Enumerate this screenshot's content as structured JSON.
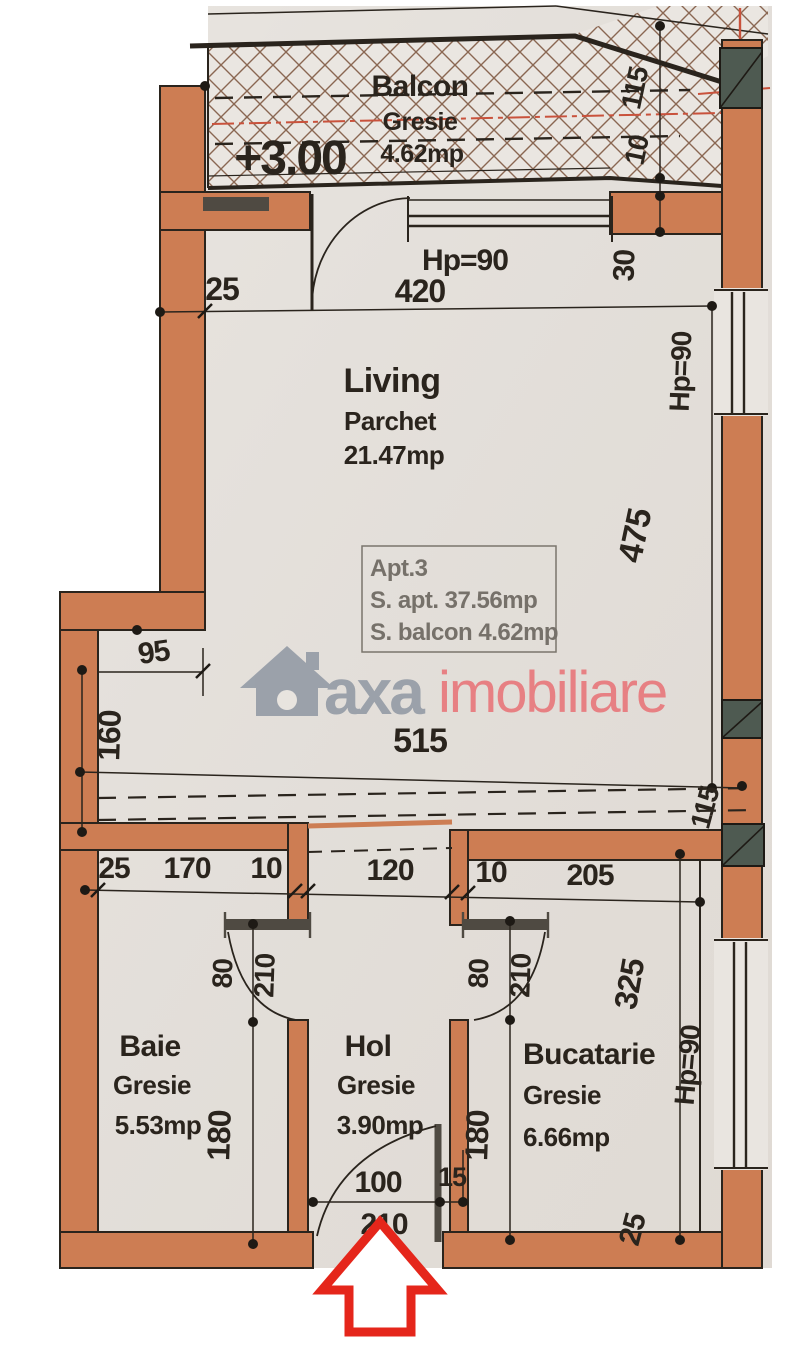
{
  "plan": {
    "level_marker": "+3.00",
    "rooms": {
      "balcon": {
        "name": "Balcon",
        "finish": "Gresie",
        "area": "4.62mp"
      },
      "living": {
        "name": "Living",
        "finish": "Parchet",
        "area": "21.47mp"
      },
      "baie": {
        "name": "Baie",
        "finish": "Gresie",
        "area": "5.53mp"
      },
      "hol": {
        "name": "Hol",
        "finish": "Gresie",
        "area": "3.90mp"
      },
      "bucatarie": {
        "name": "Bucatarie",
        "finish": "Gresie",
        "area": "6.66mp"
      }
    },
    "apartment_info": {
      "line1": "Apt.3",
      "line2": "S. apt. 37.56mp",
      "line3": "S. balcon 4.62mp"
    },
    "dimensions": {
      "balcony_width": "115",
      "balcony_rail": "10",
      "living_wall_left": "25",
      "living_opening": "420",
      "living_opening_height": "Hp=90",
      "living_right_offset": "30",
      "living_window_height": "Hp=90",
      "living_depth": "475",
      "living_niche": "115",
      "step_width": "95",
      "step_depth": "160",
      "living_width": "515",
      "chain_left_wall": "25",
      "baie_width": "170",
      "wall_baie_hol": "10",
      "hol_width": "120",
      "wall_hol_buc": "10",
      "bucatarie_width": "205",
      "baie_door_width": "80",
      "baie_door_height": "210",
      "baie_depth": "180",
      "buc_door_width": "80",
      "buc_door_height": "210",
      "buc_depth": "180",
      "bucatarie_depth": "325",
      "buc_window_height": "Hp=90",
      "bottom_wall": "25",
      "entry_door_width": "100",
      "entry_jamb": "15",
      "entry_door_height": "210"
    },
    "watermark": {
      "brand": "axa",
      "brand_suffix": "imobiliare"
    },
    "colors": {
      "wall": "#cd7d53",
      "column": "#4e5a51",
      "line": "#2a241d",
      "paper": "#e9e5e0",
      "red_marker": "#e5261b",
      "axis_red": "#c9523c",
      "watermark_gray": "#959ca7",
      "watermark_red": "#e8797c"
    }
  }
}
